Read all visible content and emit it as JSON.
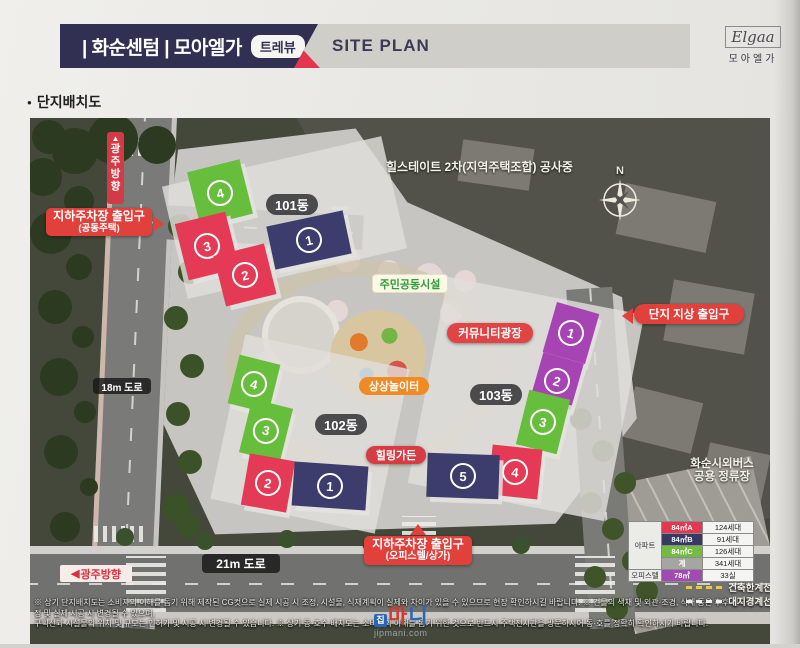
{
  "header": {
    "title": "| 화순센텀 | 모아엘가",
    "badge": "트레뷰",
    "site_plan": "SITE PLAN",
    "logo_script": "Elgaa",
    "logo_name": "모아엘가"
  },
  "subtitle_bullet": "●",
  "subtitle": "단지배치도",
  "map": {
    "compass_n": "N",
    "construction_note": "힐스테이트 2차(지역주택조합) 공사중",
    "labels": {
      "up_arrow": "▲",
      "left_arrow": "◀",
      "gwangju_vertical": "광주방향",
      "gwangju_left": "광주방향",
      "road_18m": "18m 도로",
      "road_21m": "21m 도로",
      "parking_residential_1": "지하주차장 출입구",
      "parking_residential_2": "(공동주택)",
      "parking_officetel_1": "지하주차장 출입구",
      "parking_officetel_2": "(오피스텔/상가)",
      "community_facility": "주민공동시설",
      "community_plaza": "커뮤니티광장",
      "imagination_playground": "상상놀이터",
      "healing_garden": "힐링가든",
      "site_ground_entrance": "단지 지상 출입구",
      "bus_stop_1": "화순시외버스",
      "bus_stop_2": "공용 정류장"
    },
    "groups": [
      {
        "label": "101동",
        "units": [
          "4",
          "1",
          "3",
          "2"
        ]
      },
      {
        "label": "102동",
        "units": [
          "4",
          "3",
          "2",
          "1"
        ]
      },
      {
        "label": "103동",
        "units": [
          "1",
          "2",
          "3",
          "4",
          "5"
        ]
      }
    ]
  },
  "legend": {
    "rows": [
      {
        "category": "아파트",
        "type": "84㎡A",
        "count": "124세대"
      },
      {
        "category": "",
        "type": "84㎡B",
        "count": "91세대"
      },
      {
        "category": "",
        "type": "84㎡C",
        "count": "126세대"
      },
      {
        "category": "",
        "type": "계",
        "count": "341세대"
      },
      {
        "category": "오피스텔",
        "type": "78㎡",
        "count": "33실"
      }
    ],
    "building_limit_line": "건축한계선",
    "site_boundary_line": "대지경계선"
  },
  "disclaimer": {
    "line1": "※ 상기 단지배치도는 소비자의 이해를 돕기 위해 제작된 CG컷으로 실제 시공 시 조정, 시설물, 식재계획이 실제와 차이가 있을 수 있으므로 현장 확인하시길 바랍니다. ※ 건물의 색채 및 외관·조경, 식재 등은 추후 인허가 과정 및 실제 시공 시 변경될 수 있으며,",
    "line2": "구획선과 시설물의 위치 및 규모는 인허가 및 시공 시 변경될 수 있습니다. ※ 상기 동·호수 배치도는 소비자의 이해를 돕기 위한 것으로 반드시 주택전시관을 방문하시어 동·호를 정확히 확인하시기 바랍니다."
  },
  "watermark": {
    "chars": [
      "집",
      "마",
      "니"
    ],
    "url": "jipmani.com"
  },
  "colors": {
    "header_navy": "#312f52",
    "accent_red": "#e3354e",
    "bar_gray": "#cfcec9",
    "building_red": "#e43a55",
    "building_navy": "#3c3d6c",
    "building_green": "#67bd3c",
    "building_purple": "#a644b4",
    "label_red": "#e2403b",
    "label_orange": "#ef8a25",
    "label_green_text": "#2f9e36",
    "legend_total_gray": "#a5a5a3"
  }
}
